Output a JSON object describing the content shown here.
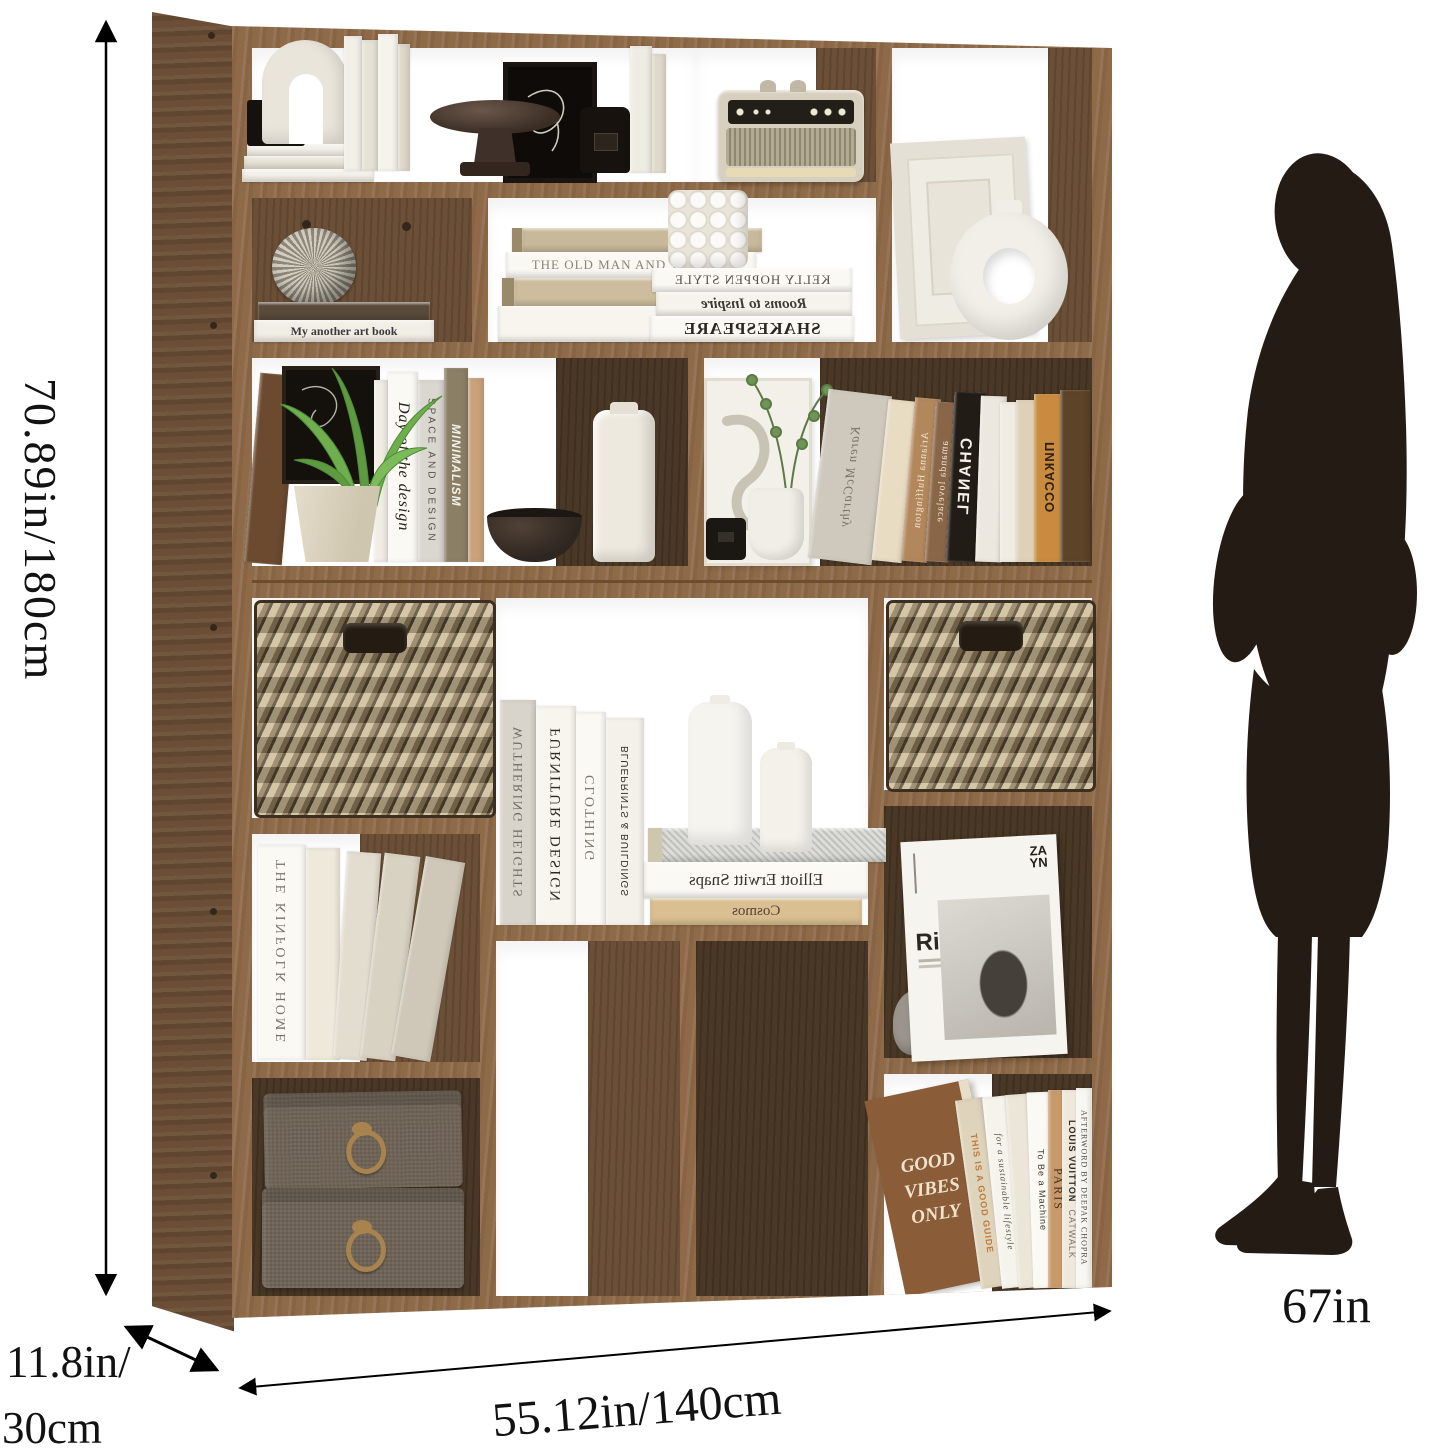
{
  "page": {
    "background": "#ffffff"
  },
  "annotations": {
    "height_label": "70.89in/180cm",
    "depth_label_line1": "11.8in/",
    "depth_label_line2": "30cm",
    "width_label": "55.12in/140cm",
    "person_height_label": "67in"
  },
  "colors": {
    "wood_front": "#8e6a48",
    "wood_side": "#6b4e35",
    "wood_back": "#4a3826",
    "basket": "#a8916c",
    "silhouette": "#251b15",
    "annotation_line": "#000000"
  },
  "titles": {
    "my_art_book": "My another art book",
    "old_man_sea": "THE OLD MAN AND THE SEA",
    "kelly_hoppen": "KELLY HOPPEN STYLE",
    "rooms_inspire": "Rooms to Inspire",
    "shakespeare": "SHAKESPEARE",
    "day_design": "Day of the design",
    "space_design": "SPACE AND DESIGN",
    "minimalism": "MINIMALISM",
    "karen": "Karen McCarthy",
    "arianna": "Arianna Huffington",
    "amanda": "amanda lovelace",
    "chanel": "CHANEL",
    "picasso": "ПИКАССО",
    "wuthering": "WUTHERING HEIGHTS",
    "furniture": "FURNITURE DESIGN",
    "clothing": "CLOTHING",
    "blueprints": "BLUEPRINTS & BUILDINGS",
    "elliott": "Elliott Erwitt Snaps",
    "cosmos": "Cosmos",
    "kinfolk": "THE KINFOLK HOME",
    "river_road": "River Road",
    "zayn_line1": "ZA",
    "zayn_line2": "YN",
    "good_vibes": [
      "GOOD",
      "VIBES",
      "ONLY"
    ],
    "good_guide": "THIS IS A GOOD GUIDE",
    "sustainable": "for a sustainable lifestyle",
    "machine": "To Be a Machine",
    "paris": "PARIS",
    "louis_vuitton": "LOUIS VUITTON",
    "catwalk": "CATWALK",
    "afterword": "AFTERWORD BY DEEPAK CHOPRA"
  }
}
